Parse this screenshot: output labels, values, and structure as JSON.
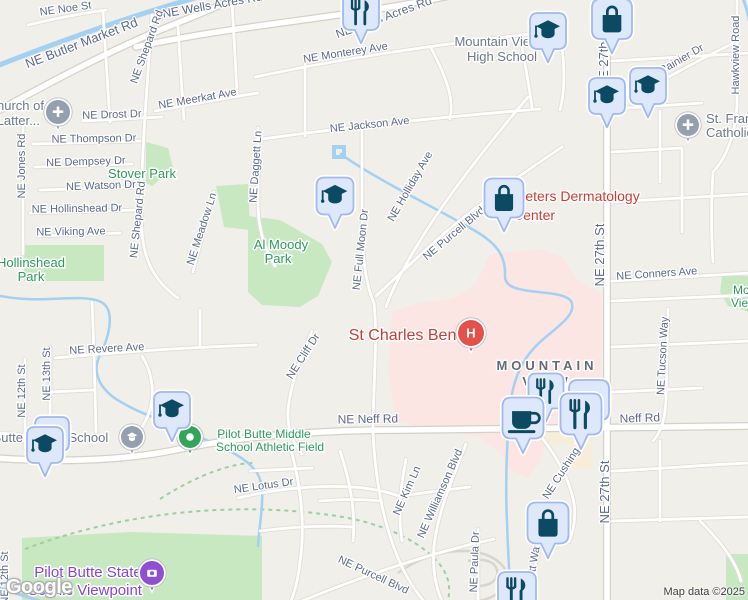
{
  "logo": {
    "text": "Google"
  },
  "attribution": {
    "map_data": "Map data ©2025"
  },
  "colors": {
    "bg": "#f1efe9",
    "road_fill": "#ffffff",
    "road_case": "#e0ddd6",
    "major_case": "#d5d1c9",
    "water": "#a4d0f1",
    "park": "#c8e8c2",
    "hospital_area": "#fbe6e3",
    "building": "#f6eed8",
    "trail": "#9ccf9f",
    "butte_road": "#d8d5ce",
    "street_label": "#5c6b8a",
    "gray_poi": "#6f7988",
    "area_label": "#646b76",
    "green_label": "#2f9a5c",
    "red_label": "#c93d33",
    "purple_label": "#8746cf",
    "pin_fill": "#dee8fb",
    "pin_border": "#a2b8ef",
    "pin_icon": "#0c4a63",
    "gray_dot": "#95a0ae",
    "green_dot": "#34a45a",
    "red_dot": "#e2524a",
    "purple_dot": "#8e4fd0",
    "attribution_text": "#3c4043"
  },
  "areas": {
    "hospital": [
      "392,312 420,303 452,299 476,284 490,254 540,249 562,257 578,280 602,294 602,420 560,424 545,440 540,462 528,478 510,470 500,452 478,436 430,430 396,421 388,372"
    ],
    "parks": [
      "146,142 168,148 173,168 152,186 146,183",
      "216,186 248,184 250,230 224,227",
      "248,216 280,220 322,244 332,262 318,296 300,307 262,305 248,292",
      "24,245 104,245 104,281 24,281",
      "22,538 130,532 262,536 262,602 22,602",
      "726,554 750,554 750,602 726,602",
      "722,276 750,276 750,312 728,306 720,292"
    ],
    "buildings": [
      "543,424 575,424 575,444 543,444",
      "570,438 592,438 592,468 570,468"
    ]
  },
  "water": [
    {
      "d": "M-6,67 C60,41 130,16 202,-4",
      "w": 5
    },
    {
      "d": "M742,-4 C746,6 748,13 749,20",
      "w": 3
    },
    {
      "d": "M341,154 C370,176 432,206 472,229 C497,243 506,256 505,276 C504,298 560,287 571,301 C579,316 550,331 536,346 C521,361 513,381 510,406 C507,441 505,481 507,521 C508,556 510,581 511,604",
      "w": 2.5
    },
    {
      "d": "M-4,295 C40,305 76,293 99,301 C117,308 109,337 100,355 C91,373 101,389 116,399 C141,415 166,421 191,433 C221,447 246,456 257,473 C267,489 260,516 258,546",
      "w": 2.5
    },
    {
      "d": "M-4,587 C15,593 32,598 48,604",
      "w": 3
    },
    {
      "d": "M334,147 L344,147 L344,157 L334,157 Z",
      "w": 4
    }
  ],
  "trails": [
    "M25,549 C120,513 230,501 330,515 C390,523 426,546 441,566 C452,581 450,596 446,606",
    "M160,499 C200,473 235,463 253,463"
  ],
  "butte_roads": [
    "M398,573 C430,549 478,543 500,563 C515,577 505,597 478,601",
    "M468,561 C486,557 499,563 497,575 C495,585 479,589 469,583"
  ],
  "roads": {
    "major": [
      "M-6,113 C40,88 100,55 160,30 C185,20 215,8 240,-4",
      "M136,47 C240,24 350,18 458,-6",
      "M607,-6 L607,606",
      "M-6,458 C50,462 120,462 180,449 C255,434 330,430 402,430 L750,426"
    ],
    "minor": [
      "M28,25 C60,17 85,13 106,10",
      "M152,15 C147,90 139,180 142,232 C144,264 158,284 178,298",
      "M103,12 C106,60 108,95 110,122",
      "M178,26 C180,62 182,92 184,120",
      "M232,2 C234,40 236,70 237,94",
      "M23,126 L23,254",
      "M33,144 L140,141",
      "M35,167 L132,164",
      "M40,190 L138,187",
      "M30,213 L136,210",
      "M38,236 L120,233",
      "M83,121 L162,117",
      "M155,111 C195,104 225,98 258,93",
      "M258,128 L258,202 C258,229 265,250 275,266",
      "M214,192 C206,222 199,248 193,272",
      "M255,77 C330,61 430,45 540,33",
      "M255,140 C340,128 440,117 540,109",
      "M305,63 L305,136",
      "M362,131 L362,216 C362,256 366,286 374,303",
      "M528,97 C484,149 445,199 418,244 C404,267 392,289 386,307",
      "M562,147 C510,182 462,216 430,246 C410,264 390,283 376,296",
      "M374,303 C378,340 373,385 373,432",
      "M373,432 C375,475 382,520 398,558 C406,578 416,592 426,604",
      "M55,358 C130,351 200,347 256,345",
      "M50,347 L50,432",
      "M25,359 L25,447",
      "M92,302 C94,345 95,390 96,432",
      "M50,392 L94,390",
      "M312,331 C300,359 290,386 288,411 C287,429 293,443 302,454",
      "M238,498 C275,489 315,485 352,487 C372,488 387,492 399,496",
      "M406,459 C400,490 398,516 402,541",
      "M466,444 C452,480 438,511 434,546 C432,571 436,589 443,603",
      "M478,529 L478,603",
      "M543,439 C558,459 570,481 574,503 C576,517 574,530 569,542",
      "M540,546 C535,566 531,583 531,603",
      "M297,603 C360,577 430,553 494,539",
      "M668,309 L666,400 C665,420 661,432 653,441",
      "M640,93 C672,75 704,57 738,41",
      "M737,-6 L737,105 C735,136 726,158 713,172",
      "M612,281 L750,273",
      "M612,301 L750,295",
      "M612,347 L750,341",
      "M612,392 L702,388",
      "M612,471 C660,469 700,465 750,463",
      "M612,521 L750,517",
      "M660,441 L660,521",
      "M700,521 C720,541 736,561 741,581",
      "M612,61 L750,53",
      "M612,109 L702,103",
      "M660,111 L660,182",
      "M612,152 L682,148",
      "M682,150 L682,232",
      "M612,202 L750,194",
      "M713,172 C711,202 711,232 713,262",
      "M290,446 C300,482 306,522 300,562 C298,582 294,594 290,604",
      "M340,451 C350,481 356,511 353,541",
      "M250,471 L312,468",
      "M320,501 C342,499 362,499 382,501",
      "M260,531 C292,527 322,525 352,527",
      "M398,496 C425,493 450,489 470,487",
      "M430,46 C448,80 454,100 450,119",
      "M520,36 C526,70 530,90 532,108",
      "M560,33 C566,70 564,95 560,110",
      "M140,430 C160,402 152,372 142,356",
      "M200,347 L200,310",
      "M0,433 C30,436 60,438 90,436"
    ]
  },
  "street_labels": [
    {
      "t": "NE Noe St",
      "x": 66,
      "y": 12,
      "r": -8
    },
    {
      "t": "NE Butler Market Rd",
      "x": 83,
      "y": 47,
      "r": -21,
      "s": 13
    },
    {
      "t": "NE Wells Acres Rd",
      "x": 213,
      "y": 9,
      "r": -10,
      "s": 12
    },
    {
      "t": "NE Wells Acres Rd",
      "x": 385,
      "y": 21,
      "r": -20,
      "s": 12
    },
    {
      "t": "NE Shepard Rd",
      "x": 150,
      "y": 48,
      "r": -70
    },
    {
      "t": "NE Monterey Ave",
      "x": 346,
      "y": 56,
      "r": -9
    },
    {
      "t": "NE Meerkat Ave",
      "x": 198,
      "y": 102,
      "r": -10
    },
    {
      "t": "NE Drost Dr",
      "x": 112,
      "y": 118,
      "r": -2
    },
    {
      "t": "NE Jackson Ave",
      "x": 370,
      "y": 128,
      "r": -6
    },
    {
      "t": "NE Thompson Dr",
      "x": 94,
      "y": 142,
      "r": -1
    },
    {
      "t": "NE Dempsey Dr",
      "x": 86,
      "y": 165,
      "r": -2
    },
    {
      "t": "NE Watson Dr",
      "x": 101,
      "y": 189,
      "r": -2
    },
    {
      "t": "NE Hollinshead Dr",
      "x": 77,
      "y": 212,
      "r": -1
    },
    {
      "t": "NE Viking Ave",
      "x": 71,
      "y": 235,
      "r": -1
    },
    {
      "t": "NE Jones Rd",
      "x": 25,
      "y": 166,
      "r": -90
    },
    {
      "t": "NE Shepard Rd",
      "x": 141,
      "y": 220,
      "r": -84
    },
    {
      "t": "NE Meadow Ln",
      "x": 205,
      "y": 230,
      "r": -72
    },
    {
      "t": "NE Daggett Ln",
      "x": 259,
      "y": 167,
      "r": -86
    },
    {
      "t": "NE Holliday Ave",
      "x": 413,
      "y": 188,
      "r": -60
    },
    {
      "t": "NE Full Moon Dr",
      "x": 364,
      "y": 250,
      "r": -84
    },
    {
      "t": "NE Purcell Blvd",
      "x": 456,
      "y": 236,
      "r": -40
    },
    {
      "t": "NE Conners Ave",
      "x": 657,
      "y": 277,
      "r": -4
    },
    {
      "t": "NE 27th St",
      "x": 604,
      "y": 255,
      "r": -90,
      "s": 13
    },
    {
      "t": "NE 27th St",
      "x": 608,
      "y": 57,
      "r": -90,
      "s": 13
    },
    {
      "t": "NE 27th St",
      "x": 609,
      "y": 492,
      "r": -90,
      "s": 13
    },
    {
      "t": "Hawkview Road",
      "x": 739,
      "y": 55,
      "r": -90
    },
    {
      "t": "Rainier Dr",
      "x": 683,
      "y": 62,
      "r": -30
    },
    {
      "t": "NE Revere Ave",
      "x": 107,
      "y": 352,
      "r": -3
    },
    {
      "t": "NE 13th St",
      "x": 50,
      "y": 374,
      "r": -90
    },
    {
      "t": "NE 12th St",
      "x": 25,
      "y": 391,
      "r": -90
    },
    {
      "t": "NE Cliff Dr",
      "x": 306,
      "y": 358,
      "r": -57
    },
    {
      "t": "NE Neff Rd",
      "x": 368,
      "y": 423,
      "r": -1,
      "s": 12
    },
    {
      "t": "Neff Rd",
      "x": 640,
      "y": 422,
      "r": -2,
      "s": 12
    },
    {
      "t": "NE Lotus Dr",
      "x": 264,
      "y": 489,
      "r": -8
    },
    {
      "t": "NE Kim Ln",
      "x": 410,
      "y": 492,
      "r": -66
    },
    {
      "t": "NE Williamson Blvd",
      "x": 443,
      "y": 495,
      "r": -66
    },
    {
      "t": "NE Paula Dr",
      "x": 478,
      "y": 562,
      "r": -88
    },
    {
      "t": "NE Cushing Dr",
      "x": 568,
      "y": 469,
      "r": -57
    },
    {
      "t": "NE Tucson Way",
      "x": 666,
      "y": 356,
      "r": -87
    },
    {
      "t": "NE Watt Way",
      "x": 535,
      "y": 574,
      "r": -80
    },
    {
      "t": "NE Purcell Blvd",
      "x": 372,
      "y": 578,
      "r": 25
    },
    {
      "t": "NE 12th St",
      "x": 8,
      "y": 578,
      "r": -90
    }
  ],
  "poi_labels": [
    {
      "name": "mountain-view-high-school",
      "type": "gray",
      "size": 13,
      "anchor": "middle",
      "lines": [
        {
          "t": "Mountain View",
          "x": 497,
          "y": 46
        },
        {
          "t": "High School",
          "x": 502,
          "y": 61
        }
      ]
    },
    {
      "name": "church-of-latter-day-saints",
      "type": "gray",
      "size": 13,
      "anchor": "end",
      "lines": [
        {
          "t": "Church of",
          "x": 44,
          "y": 110
        },
        {
          "t": "Latter...",
          "x": 40,
          "y": 125
        }
      ]
    },
    {
      "name": "st-francis-catholic",
      "type": "gray",
      "size": 13,
      "anchor": "start",
      "lines": [
        {
          "t": "St. Francis",
          "x": 706,
          "y": 123
        },
        {
          "t": "Catholic...",
          "x": 706,
          "y": 137
        }
      ]
    },
    {
      "name": "pilot-butte-middle-school",
      "type": "gray",
      "size": 13,
      "anchor": "middle",
      "lines": [
        {
          "t": "Pilot Butte Middle School",
          "x": 36,
          "y": 442
        }
      ]
    },
    {
      "name": "mountain-view-neighborhood",
      "type": "area",
      "size": 13,
      "anchor": "middle",
      "ls": 4,
      "bold": true,
      "lines": [
        {
          "t": "MOUNTAIN",
          "x": 547,
          "y": 370
        },
        {
          "t": "VIEW",
          "x": 547,
          "y": 386
        }
      ]
    },
    {
      "name": "stover-park",
      "type": "green",
      "size": 13,
      "anchor": "middle",
      "lines": [
        {
          "t": "Stover Park",
          "x": 142,
          "y": 178
        }
      ]
    },
    {
      "name": "al-moody-park",
      "type": "green",
      "size": 13,
      "anchor": "middle",
      "lines": [
        {
          "t": "Al Moody",
          "x": 281,
          "y": 249
        },
        {
          "t": "Park",
          "x": 278,
          "y": 263
        }
      ]
    },
    {
      "name": "hollinshead-park",
      "type": "green",
      "size": 13,
      "anchor": "middle",
      "lines": [
        {
          "t": "Hollinshead",
          "x": 31,
          "y": 267
        },
        {
          "t": "Park",
          "x": 31,
          "y": 281
        }
      ]
    },
    {
      "name": "pilot-butte-athletic-field",
      "type": "green",
      "size": 12,
      "anchor": "middle",
      "lines": [
        {
          "t": "Pilot Butte Middle",
          "x": 264,
          "y": 438
        },
        {
          "t": "School Athletic Field",
          "x": 270,
          "y": 451
        }
      ]
    },
    {
      "name": "mountain-view-park",
      "type": "green",
      "size": 12,
      "anchor": "start",
      "lines": [
        {
          "t": "Mountain",
          "x": 733,
          "y": 294
        },
        {
          "t": "View",
          "x": 731,
          "y": 307
        }
      ]
    },
    {
      "name": "peters-dermatology-center",
      "type": "red",
      "size": 14,
      "anchor": "start",
      "lines": [
        {
          "t": "Peters Dermatology",
          "x": 516,
          "y": 201
        },
        {
          "t": "Center",
          "x": 513,
          "y": 220
        }
      ]
    },
    {
      "name": "st-charles-bend",
      "type": "red",
      "size": 16,
      "anchor": "middle",
      "lines": [
        {
          "t": "St Charles Bend",
          "x": 407,
          "y": 340
        }
      ]
    },
    {
      "name": "pilot-butte-state-scenic-viewpoint",
      "type": "purple",
      "size": 15,
      "anchor": "middle",
      "lines": [
        {
          "t": "Pilot Butte State",
          "x": 88,
          "y": 577
        },
        {
          "t": "Scenic Viewpoint",
          "x": 85,
          "y": 595
        }
      ]
    }
  ],
  "markers": {
    "pins": [
      {
        "icon": "restaurant",
        "x": 361,
        "y": 12,
        "s": 36
      },
      {
        "icon": "graduation-cap",
        "x": 548,
        "y": 31,
        "s": 36
      },
      {
        "icon": "shopping-bag",
        "x": 612,
        "y": 19,
        "s": 40
      },
      {
        "icon": "graduation-cap",
        "x": 648,
        "y": 86,
        "s": 36
      },
      {
        "icon": "graduation-cap",
        "x": 607,
        "y": 96,
        "s": 36
      },
      {
        "icon": "graduation-cap",
        "x": 335,
        "y": 196,
        "s": 37
      },
      {
        "icon": "shopping-bag",
        "x": 504,
        "y": 198,
        "s": 39
      },
      {
        "icon": "graduation-cap",
        "x": 172,
        "y": 410,
        "s": 36
      },
      {
        "icon": "plain",
        "x": 52,
        "y": 434,
        "s": 34
      },
      {
        "icon": "graduation-cap",
        "x": 45,
        "y": 445,
        "s": 36
      },
      {
        "icon": "restaurant",
        "x": 546,
        "y": 391,
        "s": 35
      },
      {
        "icon": "plain",
        "x": 589,
        "y": 400,
        "s": 40
      },
      {
        "icon": "coffee-cup",
        "x": 523,
        "y": 418,
        "s": 41
      },
      {
        "icon": "restaurant",
        "x": 581,
        "y": 414,
        "s": 41
      },
      {
        "icon": "shopping-bag",
        "x": 548,
        "y": 523,
        "s": 41
      },
      {
        "icon": "restaurant",
        "x": 517,
        "y": 591,
        "s": 38
      }
    ],
    "dots": [
      {
        "icon": "church-cross",
        "x": 58,
        "y": 112,
        "color": "gray_dot",
        "r": 12
      },
      {
        "icon": "church-cross",
        "x": 688,
        "y": 125,
        "color": "gray_dot",
        "r": 11
      },
      {
        "icon": "school-cap",
        "x": 132,
        "y": 437,
        "color": "gray_dot",
        "r": 11
      },
      {
        "icon": "white-dot",
        "x": 190,
        "y": 437,
        "color": "green_dot",
        "r": 11
      },
      {
        "icon": "hospital-h",
        "x": 471,
        "y": 333,
        "color": "red_dot",
        "r": 13
      },
      {
        "icon": "camera",
        "x": 152,
        "y": 573,
        "color": "purple_dot",
        "r": 12
      }
    ]
  }
}
